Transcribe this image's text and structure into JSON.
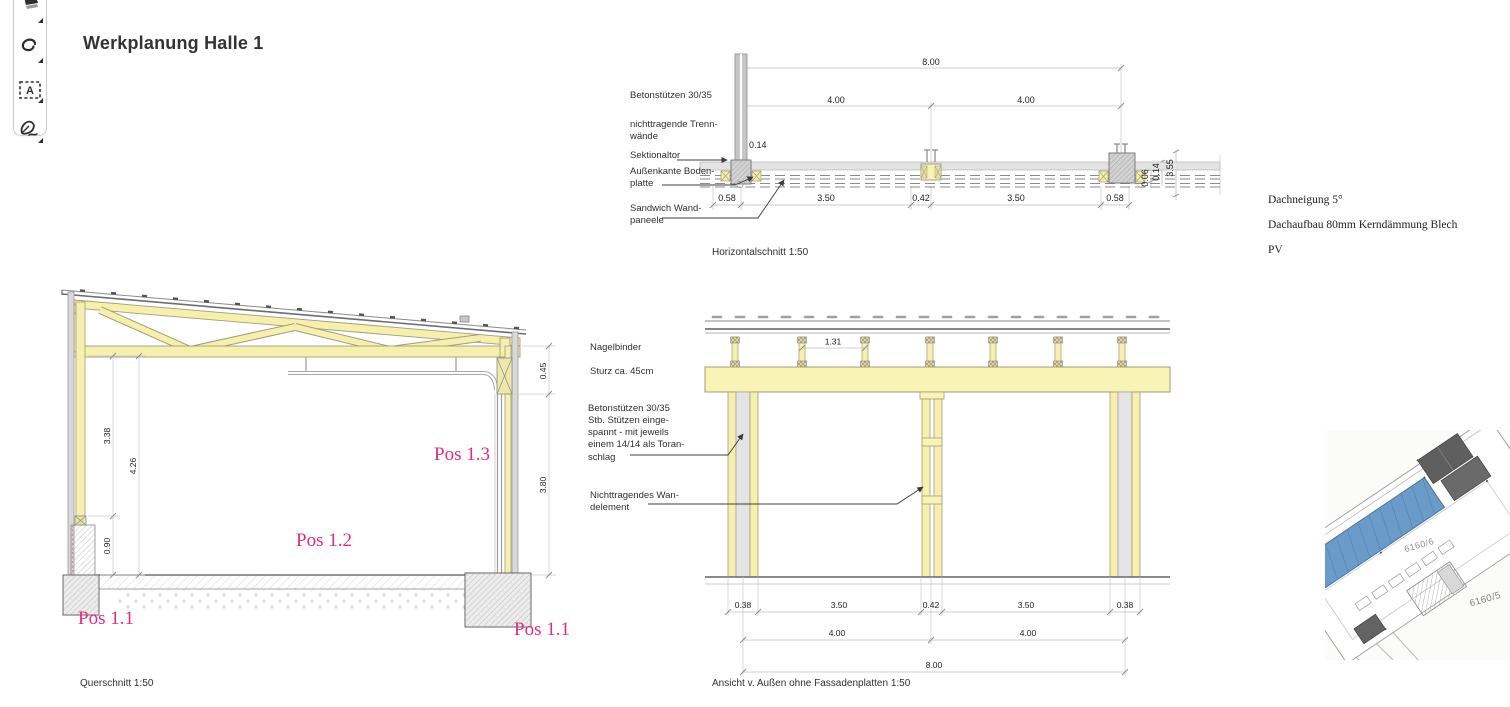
{
  "title": "Werkplanung Halle 1",
  "toolbar": {
    "icons": [
      "highlighter",
      "lasso",
      "text-select",
      "signature-pen"
    ]
  },
  "colors": {
    "wood_yellow": "#f7f0b1",
    "concrete_gray": "#d9d9d9",
    "accent_pink": "#e52a7f",
    "site_highlight_blue": "#6b9cc9"
  },
  "horizontal_section": {
    "caption": "Horizontalschnitt 1:50",
    "labels": {
      "l1": "Betonstützen 30/35",
      "l2": "nichttragende Trenn-\nwände",
      "l3": "Sektionaltor",
      "l4": "Außenkante Boden-\nplatte",
      "l5": "Sandwich Wand-\npaneele"
    },
    "dims": {
      "total": "8.00",
      "bay1": "4.00",
      "bay2": "4.00",
      "wall": "0.14",
      "c1": "0.58",
      "c2": "3.50",
      "c3": "0.42",
      "c4": "3.50",
      "c5": "0.58",
      "s1": "0.06",
      "s2": "0.14",
      "s3": "3.55"
    }
  },
  "cross_section": {
    "caption": "Querschnitt 1:50",
    "pos": {
      "p1a": "Pos 1.1",
      "p2": "Pos 1.2",
      "p3": "Pos 1.3",
      "p1b": "Pos 1.1"
    },
    "dims": {
      "h1": "3.38",
      "h2": "4.26",
      "h3": "0.90",
      "h4": "0.45",
      "h5": "3.80"
    }
  },
  "elevation": {
    "caption": "Ansicht v. Außen ohne Fassadenplatten 1:50",
    "labels": {
      "l1": "Nagelbinder",
      "l2": "Sturz ca. 45cm",
      "l3": "Betonstützen 30/35\nStb. Stützen einge-\nspannt - mit jeweils\neinem 14/14 als Toran-\nschlag",
      "l4": "Nichttragendes Wan-\ndelement"
    },
    "dims": {
      "spacing": "1.31",
      "c1": "0.38",
      "c2": "3.50",
      "c3": "0.42",
      "c4": "3.50",
      "c5": "0.38",
      "b1": "4.00",
      "b2": "4.00",
      "total": "8.00"
    }
  },
  "notes": {
    "n1": "Dachneigung 5°",
    "n2": "Dachaufbau 80mm Kerndämmung Blech",
    "n3": "PV"
  },
  "site_plan": {
    "parcel_a": "6160/6",
    "parcel_b": "6160/5"
  }
}
